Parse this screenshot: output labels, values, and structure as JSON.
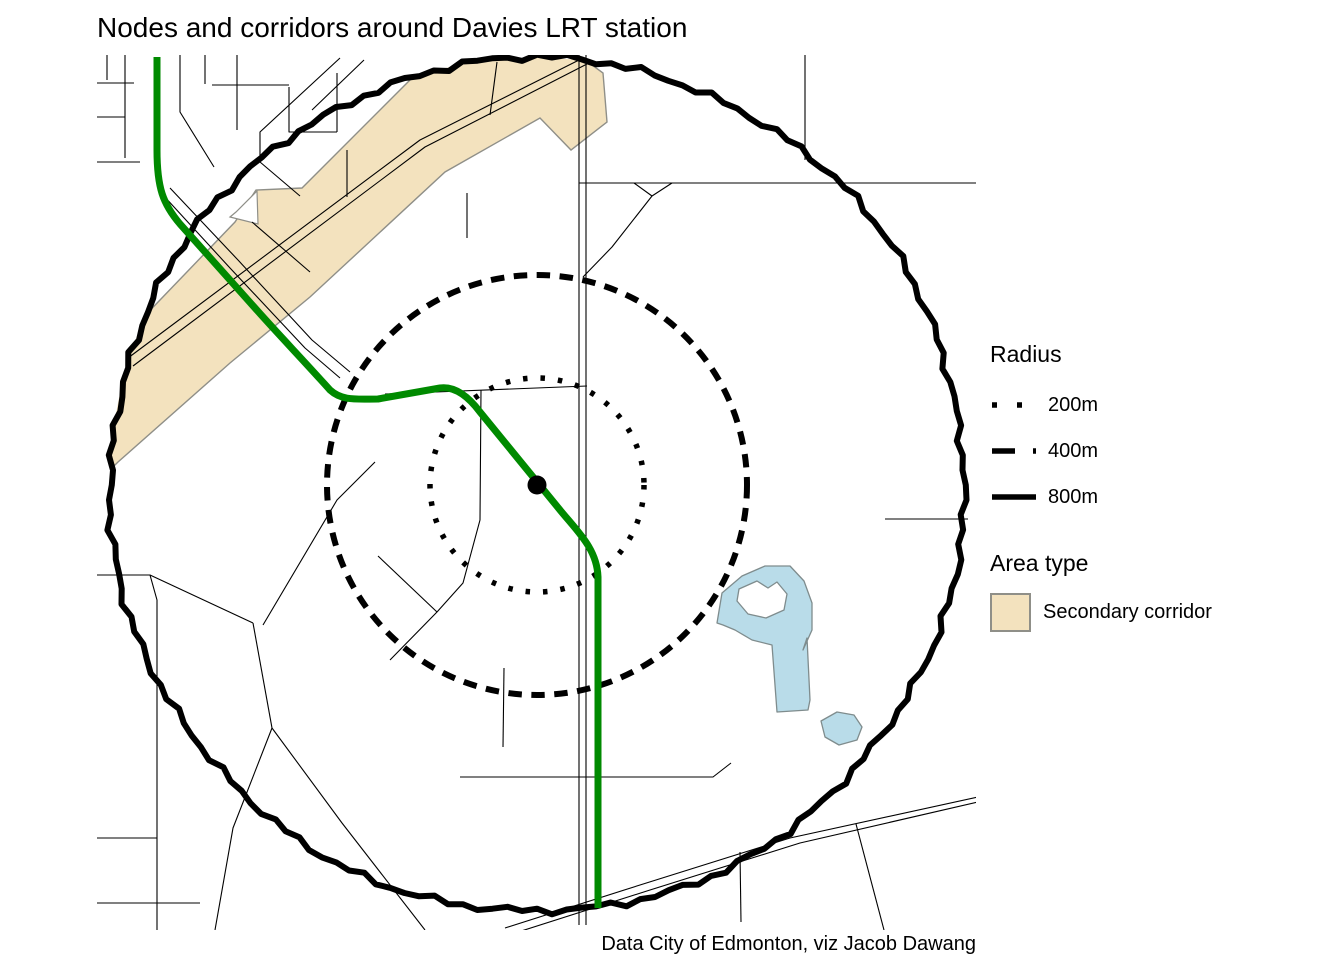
{
  "title": "Nodes and corridors around Davies LRT station",
  "caption": "Data City of Edmonton, viz Jacob Dawang",
  "legend": {
    "radius_title": "Radius",
    "radius_items": [
      {
        "label": "200m",
        "style": "dotted"
      },
      {
        "label": "400m",
        "style": "dashed"
      },
      {
        "label": "800m",
        "style": "solid"
      }
    ],
    "area_title": "Area type",
    "area_items": [
      {
        "label": "Secondary corridor",
        "fill": "#f3e2be",
        "stroke": "#8f8f88"
      }
    ]
  },
  "chart_data": {
    "type": "map",
    "title": "Nodes and corridors around Davies LRT station",
    "station": "Davies LRT station",
    "radii_m": [
      200,
      400,
      800
    ],
    "area_types": [
      "Secondary corridor"
    ],
    "source": "Data City of Edmonton, viz Jacob Dawang"
  },
  "map": {
    "panel": {
      "x": 97,
      "y": 55,
      "w": 879,
      "h": 875
    },
    "center": {
      "x": 537,
      "y": 485,
      "dot_r": 9.5
    },
    "colors": {
      "road": "#000000",
      "circle": "#000000",
      "corridor_fill": "#f3e2be",
      "corridor_stroke": "#8f8f88",
      "water_fill": "#b9dce9",
      "water_stroke": "#7f8c8d",
      "lrt_green": "#008a00",
      "background": "#ffffff"
    },
    "circles": [
      {
        "radius_m": 200,
        "r_px": 107,
        "style": "dotted",
        "width": 5.5,
        "dash": "4.5 13"
      },
      {
        "radius_m": 400,
        "r_px": 210,
        "style": "dashed",
        "width": 6,
        "dash": "13.5 9.5"
      },
      {
        "radius_m": 800,
        "r_px": 427,
        "style": "solid",
        "width": 6,
        "dash": ""
      }
    ],
    "corridor_polygons": [
      [
        [
          110,
          352
        ],
        [
          235,
          222
        ],
        [
          256,
          190
        ],
        [
          302,
          188
        ],
        [
          425,
          65
        ],
        [
          455,
          52
        ],
        [
          545,
          50
        ],
        [
          588,
          62
        ],
        [
          603,
          73
        ],
        [
          607,
          122
        ],
        [
          571,
          150
        ],
        [
          540,
          118
        ],
        [
          445,
          172
        ],
        [
          310,
          297
        ],
        [
          230,
          363
        ],
        [
          118,
          462
        ],
        [
          100,
          480
        ]
      ]
    ],
    "corridor_notches": [
      [
        [
          230,
          217
        ],
        [
          258,
          224
        ],
        [
          257,
          191
        ],
        [
          236,
          212
        ]
      ]
    ],
    "water_polygons": [
      {
        "points": [
          [
            717,
            623
          ],
          [
            722,
            593
          ],
          [
            742,
            576
          ],
          [
            765,
            566
          ],
          [
            790,
            566
          ],
          [
            804,
            581
          ],
          [
            812,
            603
          ],
          [
            812,
            630
          ],
          [
            803,
            650
          ],
          [
            807,
            638
          ],
          [
            810,
            700
          ],
          [
            808,
            710
          ],
          [
            777,
            712
          ],
          [
            772,
            645
          ],
          [
            752,
            640
          ],
          [
            735,
            630
          ],
          [
            723,
            625
          ]
        ],
        "hole": false
      },
      {
        "points": [
          [
            739,
            589
          ],
          [
            757,
            581
          ],
          [
            768,
            588
          ],
          [
            777,
            582
          ],
          [
            787,
            594
          ],
          [
            784,
            610
          ],
          [
            766,
            618
          ],
          [
            748,
            614
          ],
          [
            737,
            601
          ]
        ],
        "hole": true
      },
      {
        "points": [
          [
            821,
            721
          ],
          [
            837,
            712
          ],
          [
            854,
            715
          ],
          [
            862,
            727
          ],
          [
            857,
            740
          ],
          [
            839,
            745
          ],
          [
            825,
            737
          ]
        ],
        "hole": false
      }
    ],
    "lrt_path": "M157,57 L157,150 C157,188 163,204 180,224 L255,308 C278,334 305,362 330,390 C342,401 356,399 378,399 L440,388 C455,386 468,396 480,412 L560,510 C578,532 597,549 598,577 L598,908",
    "lrt_width": 7,
    "roads": [
      [
        [
          97,
          83
        ],
        [
          134,
          83
        ]
      ],
      [
        [
          125,
          55
        ],
        [
          125,
          158
        ]
      ],
      [
        [
          97,
          117
        ],
        [
          125,
          117
        ]
      ],
      [
        [
          107,
          55
        ],
        [
          107,
          80
        ]
      ],
      [
        [
          97,
          162
        ],
        [
          140,
          162
        ]
      ],
      [
        [
          180,
          55
        ],
        [
          180,
          112
        ],
        [
          214,
          167
        ]
      ],
      [
        [
          205,
          55
        ],
        [
          205,
          84
        ]
      ],
      [
        [
          212,
          85
        ],
        [
          289,
          85
        ]
      ],
      [
        [
          237,
          55
        ],
        [
          237,
          130
        ]
      ],
      [
        [
          289,
          87
        ],
        [
          289,
          132
        ],
        [
          337,
          132
        ]
      ],
      [
        [
          337,
          73
        ],
        [
          337,
          132
        ]
      ],
      [
        [
          340,
          58
        ],
        [
          260,
          132
        ],
        [
          260,
          162
        ],
        [
          300,
          196
        ]
      ],
      [
        [
          364,
          60
        ],
        [
          312,
          110
        ]
      ],
      [
        [
          97,
          575
        ],
        [
          150,
          575
        ],
        [
          253,
          623
        ]
      ],
      [
        [
          150,
          575
        ],
        [
          157,
          600
        ],
        [
          157,
          930
        ]
      ],
      [
        [
          97,
          838
        ],
        [
          157,
          838
        ]
      ],
      [
        [
          97,
          903
        ],
        [
          200,
          903
        ]
      ],
      [
        [
          375,
          462
        ],
        [
          337,
          500
        ],
        [
          263,
          625
        ]
      ],
      [
        [
          253,
          623
        ],
        [
          272,
          728
        ]
      ],
      [
        [
          272,
          728
        ],
        [
          233,
          828
        ],
        [
          215,
          930
        ]
      ],
      [
        [
          272,
          728
        ],
        [
          342,
          823
        ],
        [
          425,
          930
        ]
      ],
      [
        [
          460,
          777
        ],
        [
          713,
          777
        ],
        [
          731,
          763
        ]
      ],
      [
        [
          505,
          928
        ],
        [
          640,
          885
        ],
        [
          790,
          838
        ],
        [
          978,
          797
        ]
      ],
      [
        [
          515,
          933
        ],
        [
          650,
          890
        ],
        [
          800,
          843
        ],
        [
          978,
          802
        ]
      ],
      [
        [
          740,
          852
        ],
        [
          741,
          922
        ]
      ],
      [
        [
          856,
          824
        ],
        [
          884,
          930
        ]
      ],
      [
        [
          579,
          55
        ],
        [
          579,
          925
        ]
      ],
      [
        [
          586,
          55
        ],
        [
          586,
          925
        ]
      ],
      [
        [
          579,
          183
        ],
        [
          976,
          183
        ]
      ],
      [
        [
          805,
          55
        ],
        [
          805,
          160
        ]
      ],
      [
        [
          652,
          196
        ],
        [
          612,
          247
        ],
        [
          583,
          277
        ]
      ],
      [
        [
          634,
          183
        ],
        [
          652,
          196
        ],
        [
          672,
          183
        ]
      ],
      [
        [
          885,
          519
        ],
        [
          968,
          519
        ]
      ],
      [
        [
          385,
          394
        ],
        [
          587,
          386
        ]
      ],
      [
        [
          481,
          390
        ],
        [
          480,
          520
        ],
        [
          463,
          583
        ],
        [
          437,
          612
        ],
        [
          390,
          660
        ]
      ],
      [
        [
          378,
          556
        ],
        [
          437,
          612
        ]
      ],
      [
        [
          504,
          668
        ],
        [
          503,
          747
        ]
      ],
      [
        [
          128,
          358
        ],
        [
          420,
          140
        ],
        [
          583,
          58
        ]
      ],
      [
        [
          133,
          366
        ],
        [
          425,
          147
        ],
        [
          587,
          64
        ]
      ],
      [
        [
          347,
          150
        ],
        [
          347,
          197
        ]
      ],
      [
        [
          467,
          193
        ],
        [
          467,
          238
        ]
      ],
      [
        [
          252,
          222
        ],
        [
          310,
          272
        ]
      ],
      [
        [
          163,
          195
        ],
        [
          230,
          268
        ],
        [
          305,
          348
        ],
        [
          340,
          378
        ]
      ],
      [
        [
          170,
          188
        ],
        [
          238,
          260
        ],
        [
          312,
          340
        ],
        [
          350,
          372
        ]
      ],
      [
        [
          497,
          62
        ],
        [
          490,
          115
        ]
      ]
    ]
  }
}
